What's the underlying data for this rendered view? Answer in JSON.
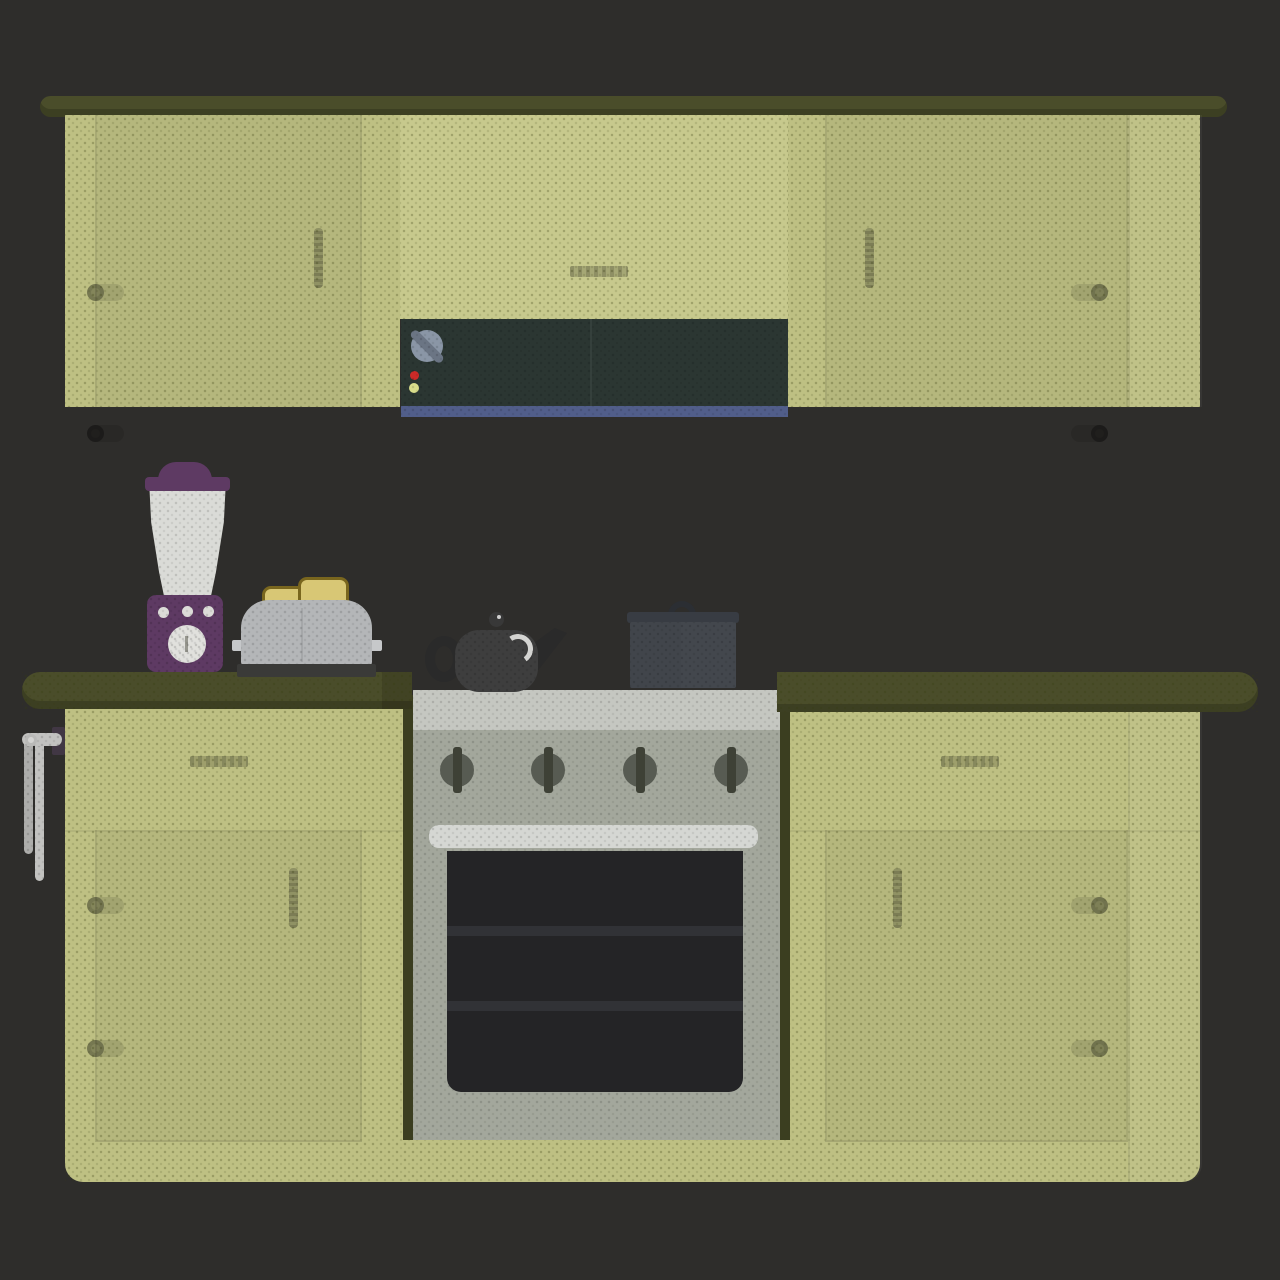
{
  "scene": {
    "title": "flat kitchen interior illustration",
    "upper_row": {
      "shelf": "dark olive top rail with rounded ends",
      "cabinets": [
        "left door cabinet with 2 hinges and vertical handle",
        "middle panel with horizontal handle",
        "right door cabinet with 2 hinges and vertical handle"
      ]
    },
    "range_hood": {
      "indicator_lights": [
        "red",
        "yellow-green"
      ],
      "control_knob": "round gray dial with diagonal grip",
      "vent_strip_color_name": "slate blue"
    },
    "lower_row": {
      "counters": [
        "left counter segment",
        "right counter segment"
      ],
      "cabinets": [
        "left cabinet: drawer with handle + door with vertical handle and 2 hinges",
        "right cabinet: drawer with handle + door with vertical handle and 2 hinges"
      ],
      "towel_rail": "wall bracket with swing arm and two hanging towels"
    },
    "stove": {
      "burner_knob_count": 4,
      "oven": "white handle bar, dark glass door with 2 rack lines"
    },
    "appliances": [
      "blender with purple base and white jar",
      "toaster with 2 toast slices",
      "black teapot kettle",
      "gray cooking pot with lid handle"
    ]
  },
  "palette": {
    "bg": "#2e2d2b",
    "cabinet": "#bec083",
    "cabinet-light": "#c7c98d",
    "counter": "#4a4d2a",
    "counter-dark": "#3b3e20",
    "hood": "#2b3632",
    "hood-strip": "#515e8a",
    "knob-face": "#8a96a6",
    "knob-grip": "#6b7584",
    "led-red": "#cc2a28",
    "led-yellow": "#d9dd8b",
    "stove-top": "#c5c7c1",
    "stove-body": "#a3a79c",
    "stove-knob": "#575b52",
    "stove-knob-bar": "#3e4136",
    "oven-handle": "#d5d7d3",
    "oven-glass": "#242426",
    "oven-rack": "#313236",
    "blender-purple": "#5e3a63",
    "blender-jar": "#dadbd7",
    "toaster-body": "#b4b6b8",
    "toaster-base": "#3a3a38",
    "toast-fill": "#d8c775",
    "toast-crust": "#79661e",
    "kettle": "#3e3e3e",
    "kettle-dark": "#2a2a2a",
    "pot": "#43474d",
    "pot-rim": "#383c43",
    "pot-handle": "#2b2e33",
    "metal-light": "#c2c2c0",
    "metal-mid": "#adadab",
    "bracket": "#413744"
  }
}
